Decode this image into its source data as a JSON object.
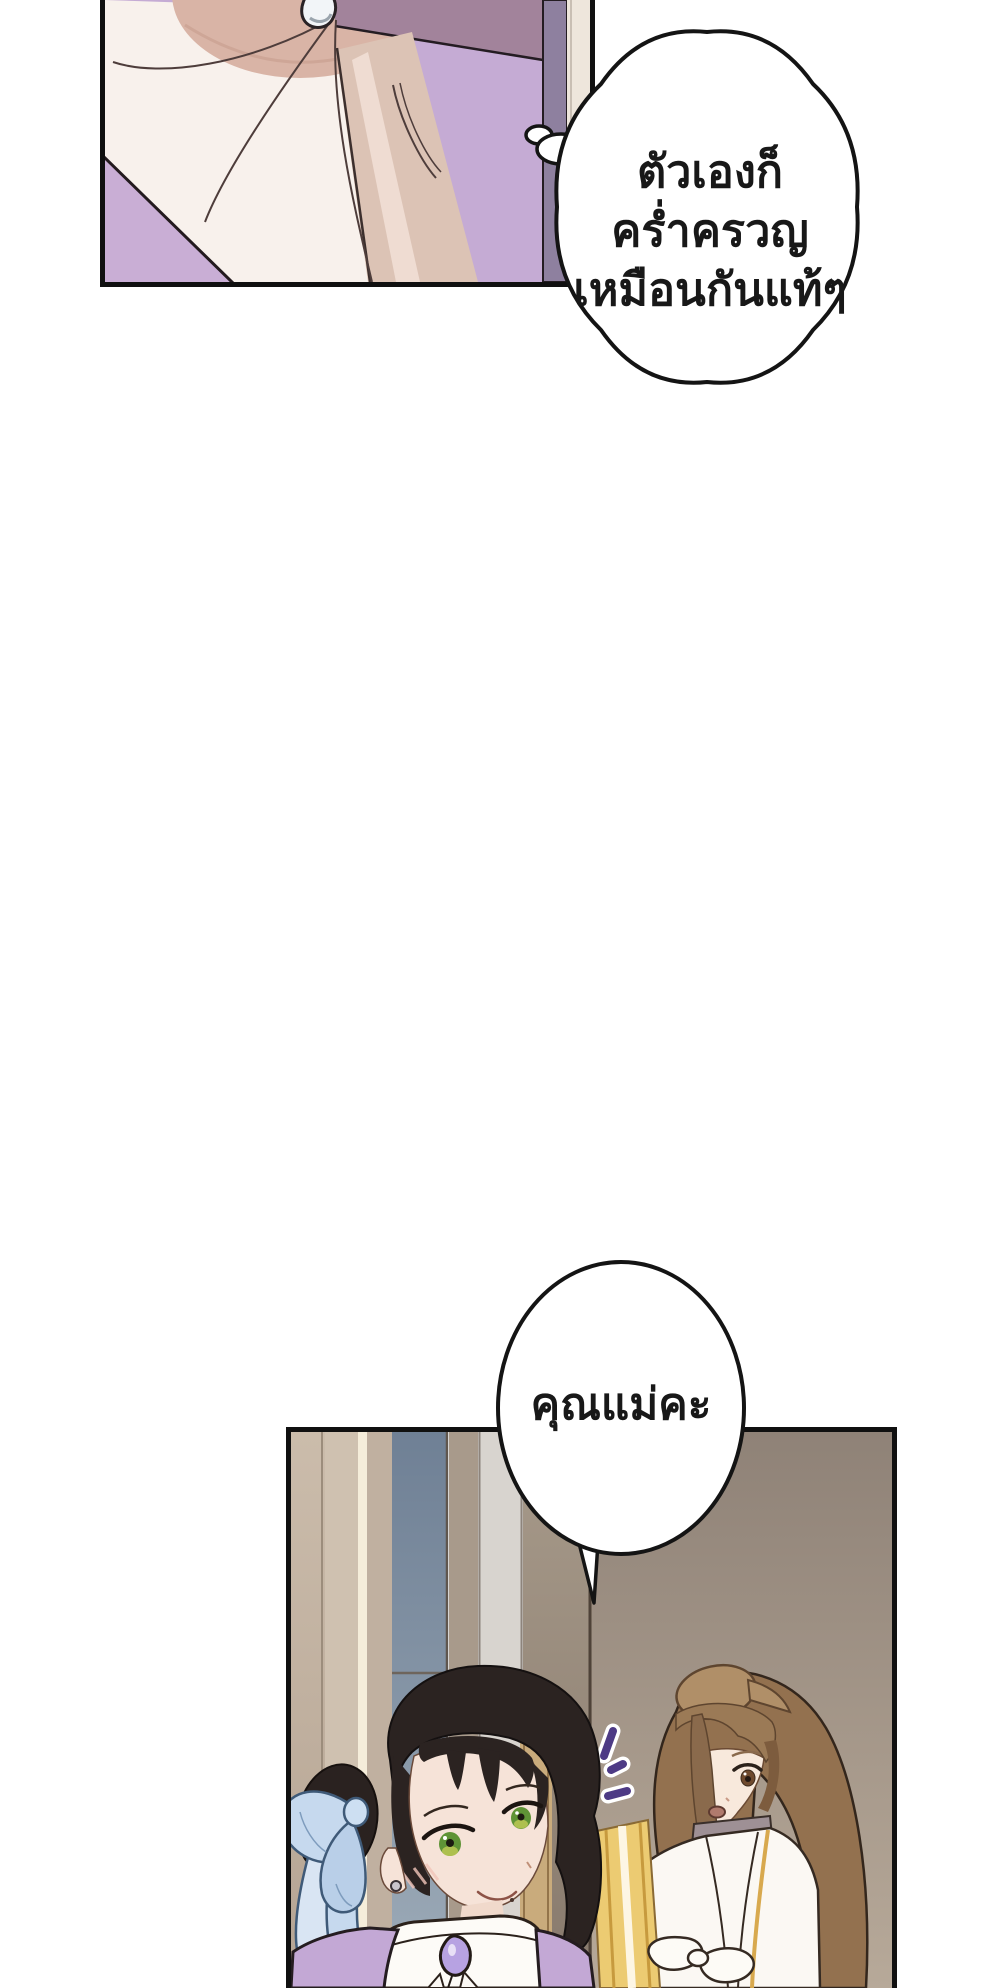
{
  "page": {
    "type": "manhwa-page",
    "background": "#ffffff"
  },
  "palette": {
    "panel_border": "#101010",
    "bedding_lavender": "#c5abd4",
    "bedding_purple": "#c9aed5",
    "skin_tone": "#d9b4a6",
    "wall_blue_stripe": "#74859a",
    "hair_bow_blue": "#c6d9ee",
    "shawl_lavender": "#c3a8d5",
    "mother_hair": "#2b2321",
    "daughter_hair": "#93714f",
    "gold_trim": "#eccb72",
    "brooch_purple": "#b7a2e2",
    "emphasis_mark_purple": "#4d3a85",
    "bubble_fill": "#ffffff",
    "bubble_outline": "#141414"
  },
  "panels": [
    {
      "id": "panel-1",
      "bubble": {
        "type": "thought",
        "lines": [
          "ตัวเองก็คร่ำครวญ",
          "เหมือนกันแท้ๆ"
        ]
      }
    },
    {
      "id": "panel-2",
      "bubble": {
        "type": "speech",
        "text": "คุณแม่คะ"
      }
    }
  ]
}
